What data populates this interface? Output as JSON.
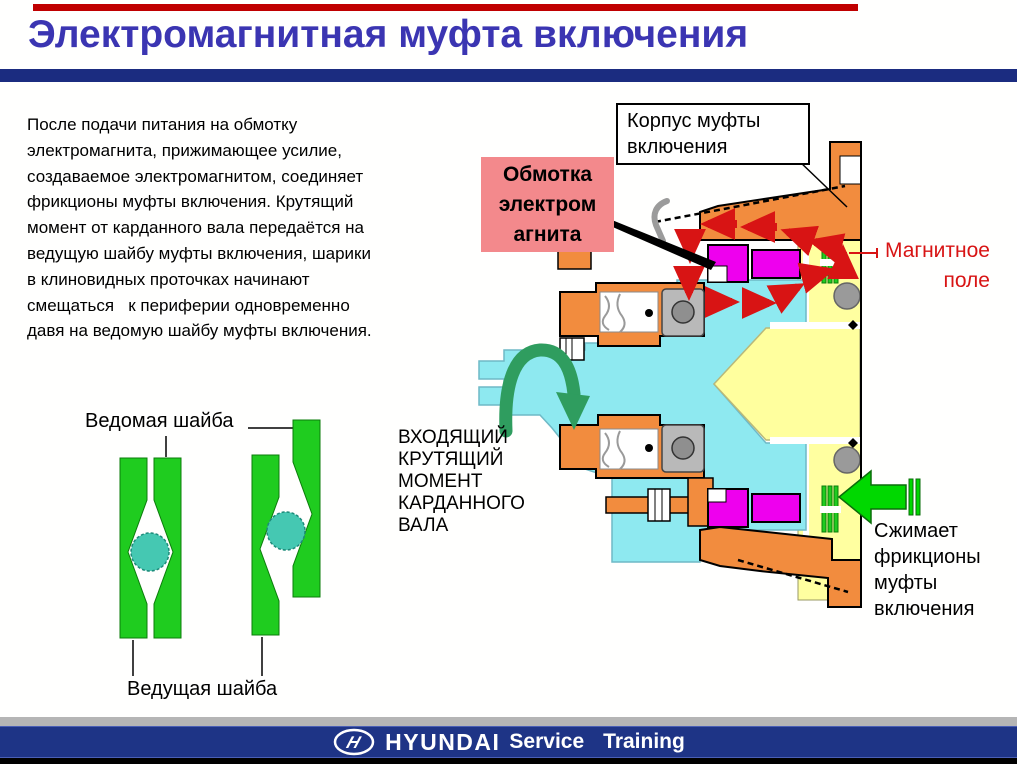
{
  "slide": {
    "title": "Электромагнитная муфта включения",
    "paragraph": "После подачи питания на обмотку\nэлектромагнита, прижимающее усилие,\nсоздаваемое электромагнитом, соединяет\nфрикционы муфты включения. Крутящий\nмомент от карданного вала передаётся на\nведущую шайбу муфты включения, шарики\nв клиновидных проточках начинают\nсмещаться   к периферии одновременно\nдавя на ведомую шайбу муфты включения."
  },
  "labels": {
    "clutch_housing": "Корпус муфты\nвключения",
    "coil": "Обмотка\nэлектром\nагнита",
    "magnetic_field": "Магнитное\nполе",
    "input_torque": "ВХОДЯЩИЙ\nКРУТЯЩИЙ\nМОМЕНТ\nКАРДАННОГО\nВАЛА",
    "compress_friction": "Сжимает\nфрикционы\nмуфты\nвключения",
    "driven_washer": "Ведомая шайба",
    "driving_washer": "Ведущая шайба"
  },
  "footer": {
    "brand": "HYUNDAI",
    "service": "Service",
    "training": "Training",
    "logo_icon": "hyundai-logo"
  },
  "colors": {
    "title_blue": "#3B35B2",
    "bar_navy": "#1B2C80",
    "top_bar_red": "#C00000",
    "housing_orange": "#F28C3E",
    "shaft_cyan": "#8EE9F0",
    "coil_magenta": "#EE00EE",
    "hub_yellow": "#FFFF9E",
    "disc_green": "#1FCC1F",
    "arrow_green": "#00D800",
    "rotation_green": "#2F9D5F",
    "field_red": "#D81414",
    "label_pink": "#F3898C",
    "ball_teal": "#45C8B2"
  }
}
